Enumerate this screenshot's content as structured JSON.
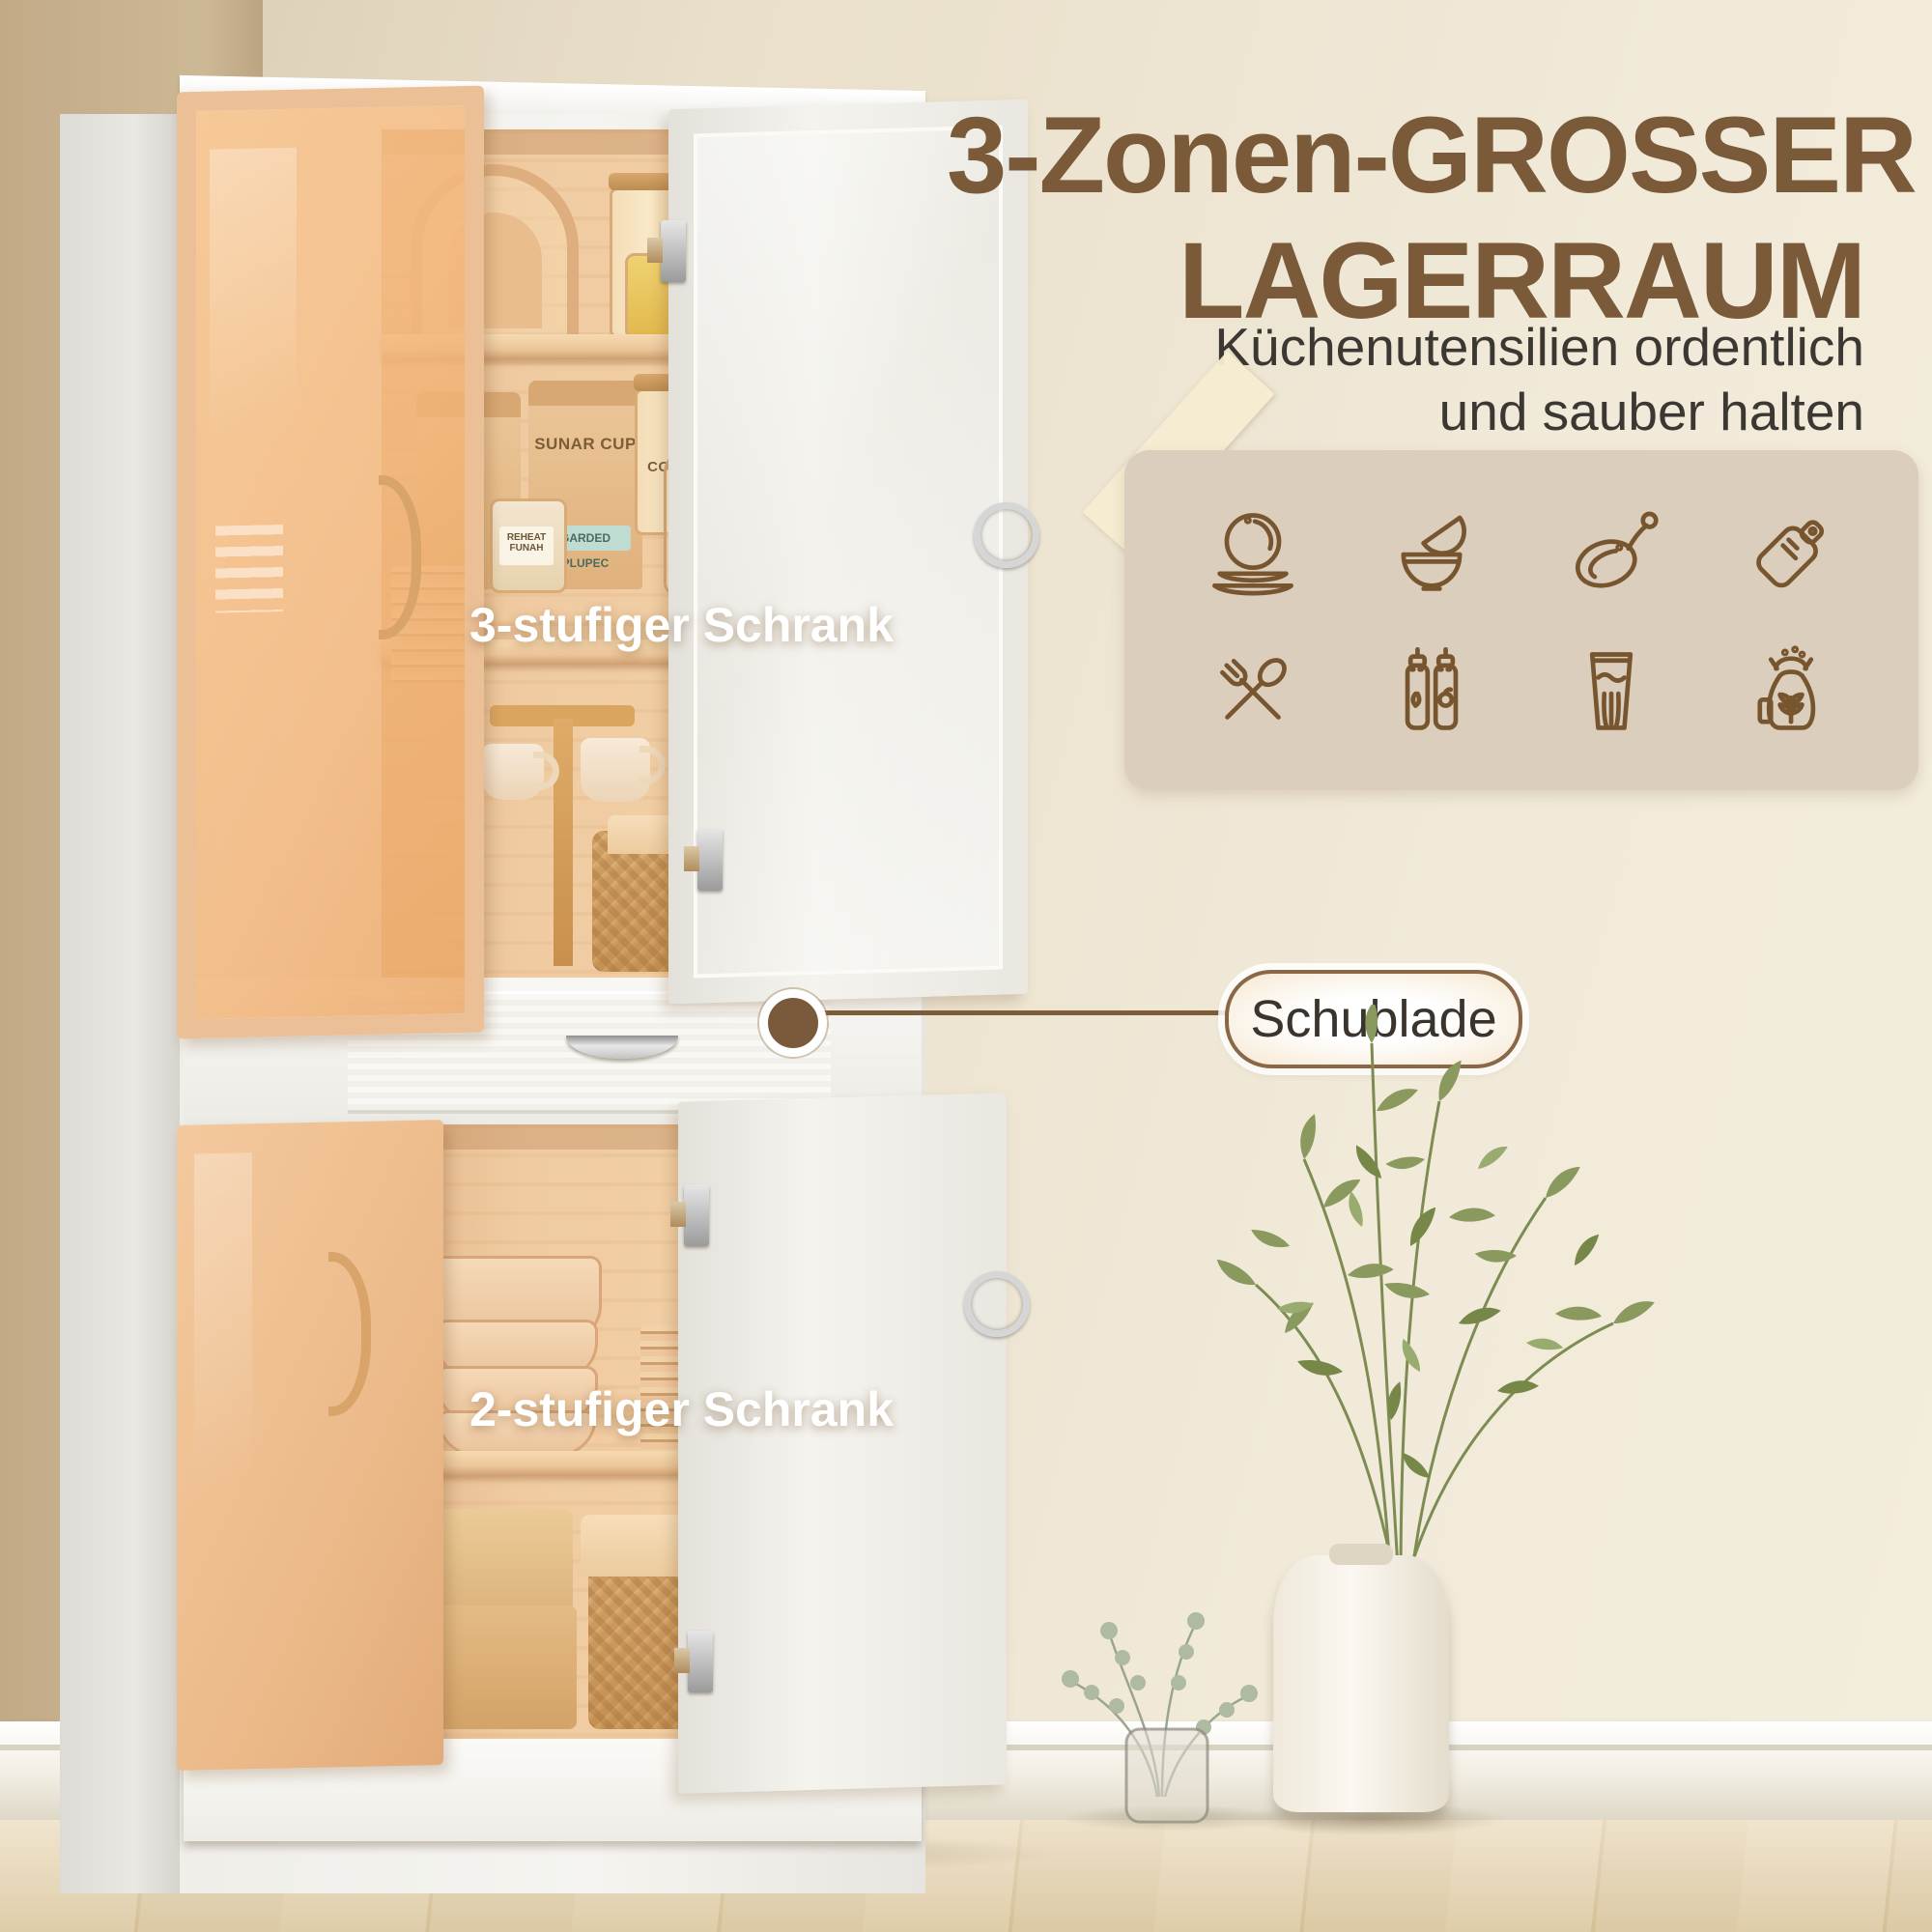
{
  "headline": {
    "line1": "3-Zonen-GROSSER",
    "line2": "LAGERRAUM",
    "color": "#7a5a38"
  },
  "subtitle": {
    "line1": "Küchenutensilien ordentlich",
    "line2": "und sauber halten"
  },
  "overlays": {
    "top_cabinet": "3-stufiger Schrank",
    "bottom_cabinet": "2-stufiger Schrank"
  },
  "callout": {
    "label": "Schublade",
    "line_color": "#7d5c3b"
  },
  "feature_panel": {
    "background": "#dbcebc",
    "icon_color": "#77552f",
    "icons": [
      {
        "name": "plates-icon"
      },
      {
        "name": "bowls-icon"
      },
      {
        "name": "frying-pan-icon"
      },
      {
        "name": "cutting-board-icon"
      },
      {
        "name": "cutlery-icon"
      },
      {
        "name": "sauce-bottles-icon"
      },
      {
        "name": "drinking-glass-icon"
      },
      {
        "name": "flour-bag-icon"
      }
    ]
  },
  "photo_labels": {
    "bag_brand": "SUNAR CUP",
    "bag_tag": "GARDED PLUPEC",
    "spice_jar": "REHEAT FUNAH",
    "canister_1": "CORNMI",
    "canister_2": "HOLE",
    "canister_3": "OAT"
  },
  "palette": {
    "wall_main": "#e9dfca",
    "wall_left": "#c9b28f",
    "cabinet_white": "#f3f2ee",
    "interior_wood": "#efc89e",
    "accent_brown": "#7a5a38",
    "floor_wood": "#e4d2ae"
  }
}
